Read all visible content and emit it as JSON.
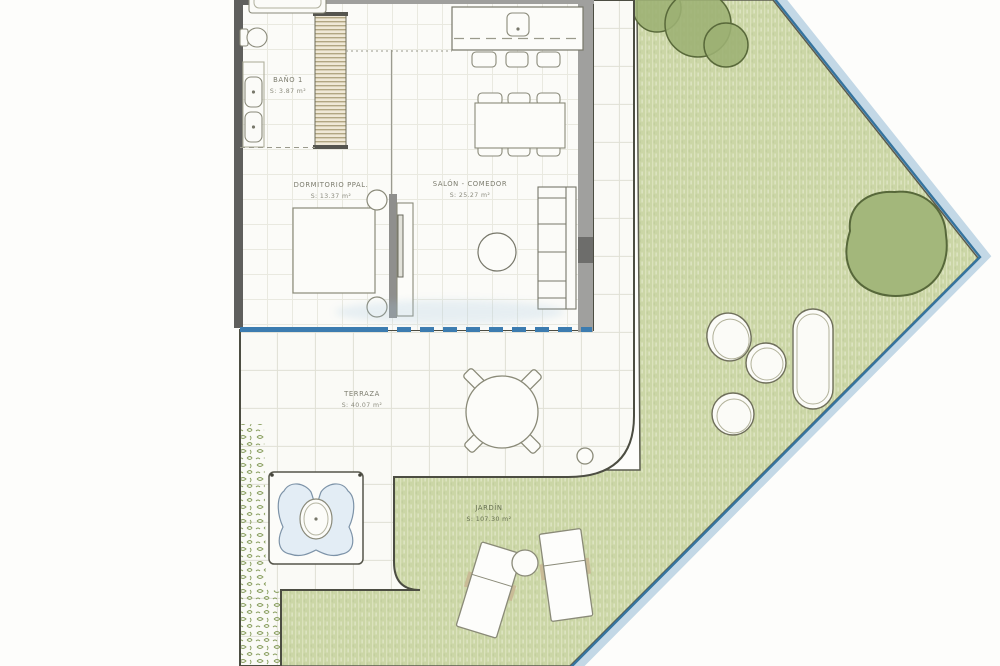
{
  "plan": {
    "type": "floor-plan",
    "rooms": [
      {
        "id": "bano1",
        "name": "BAÑO 1",
        "area": "S: 3.87 m²"
      },
      {
        "id": "dormitorio",
        "name": "DORMITORIO PPAL.",
        "area": "S: 13.37 m²"
      },
      {
        "id": "salon",
        "name": "SALÓN - COMEDOR",
        "area": "S: 25.27 m²"
      },
      {
        "id": "terraza",
        "name": "TERRAZA",
        "area": "S: 40.07 m²"
      },
      {
        "id": "jardin",
        "name": "JARDÍN",
        "area": "S: 107.30 m²"
      }
    ],
    "palette": {
      "garden_green": "#cbd6a6",
      "tree_green": "#9fb478",
      "tree_outline": "#59693a",
      "boundary_blue": "#35749f",
      "boundary_band": "#c3d8e6",
      "glass_door_blue": "#3c7cb0",
      "wall_dark": "#5f5f5d",
      "wall_light": "#9f9f9d",
      "pool_water": "#e3edf5",
      "paper_white": "#fdfdfb"
    }
  }
}
